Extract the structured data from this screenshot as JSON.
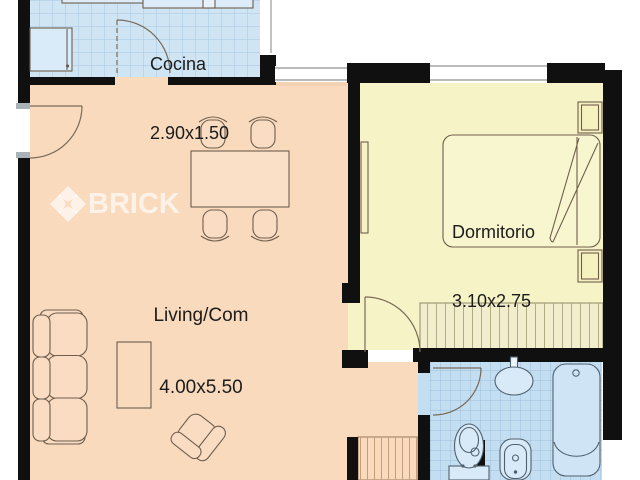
{
  "floorplan": {
    "watermark": {
      "brand": "BRICK"
    },
    "rooms": {
      "cocina": {
        "label": "Cocina",
        "dims": "2.90x1.50"
      },
      "living": {
        "label": "Living/Com",
        "dims": "4.00x5.50"
      },
      "dormitorio": {
        "label": "Dormitorio",
        "dims": "3.10x2.75"
      }
    },
    "colors": {
      "wall": "#101010",
      "kitchen_floor": "#cfe5f4",
      "bathroom_floor": "#c3ddf1",
      "living_floor": "#f9dabd",
      "bedroom_floor": "#f6f4c6",
      "closet_fill": "#f2eecd"
    },
    "furniture": [
      "fridge",
      "kitchen-counter",
      "dining-table",
      "chair",
      "sofa",
      "coffee-table",
      "armchair",
      "bed",
      "nightstand",
      "wall-shelf",
      "wardrobe",
      "hall-closet",
      "sink",
      "toilet",
      "bidet",
      "bathtub"
    ]
  }
}
